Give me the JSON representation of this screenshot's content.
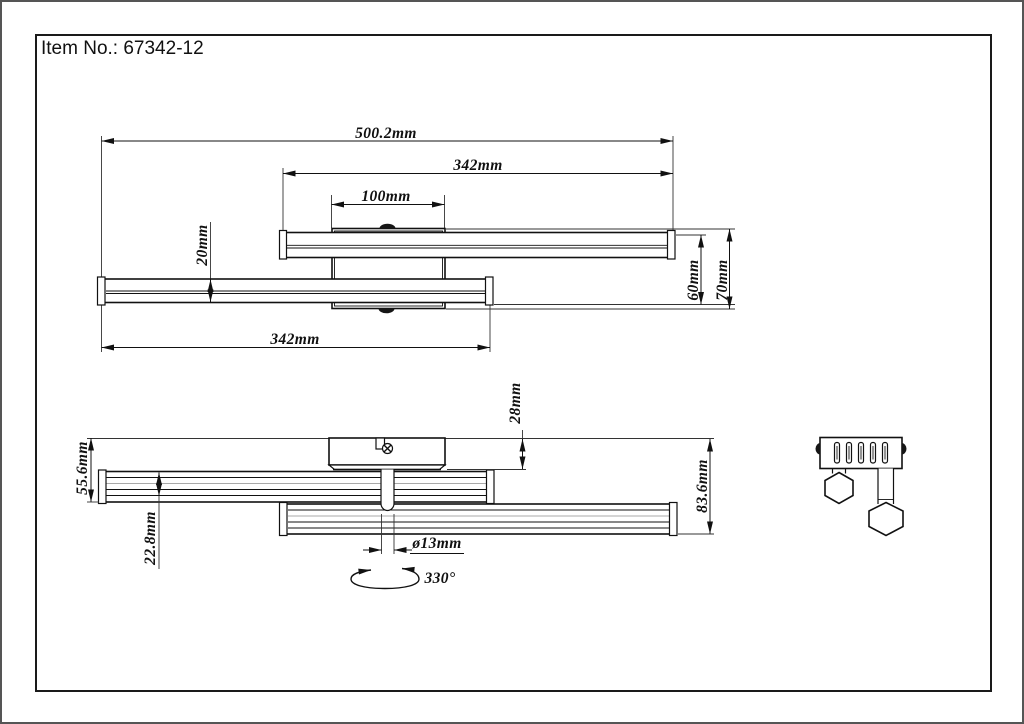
{
  "title": "Item No.: 67342-12",
  "top_view": {
    "total_width": "500.2mm",
    "upper_bar_length": "342mm",
    "canopy_width": "100mm",
    "bar_depth": "20mm",
    "bars_span_depth": "60mm",
    "overall_depth": "70mm",
    "lower_bar_length": "342mm"
  },
  "side_view": {
    "canopy_height": "28mm",
    "height_to_upper_bar": "55.6mm",
    "bar_height": "22.8mm",
    "overall_height": "83.6mm",
    "stem_diameter": "ø13mm",
    "rotation": "330°"
  },
  "colors": {
    "line": "#111111",
    "thin_line": "#333333",
    "background": "#ffffff"
  }
}
